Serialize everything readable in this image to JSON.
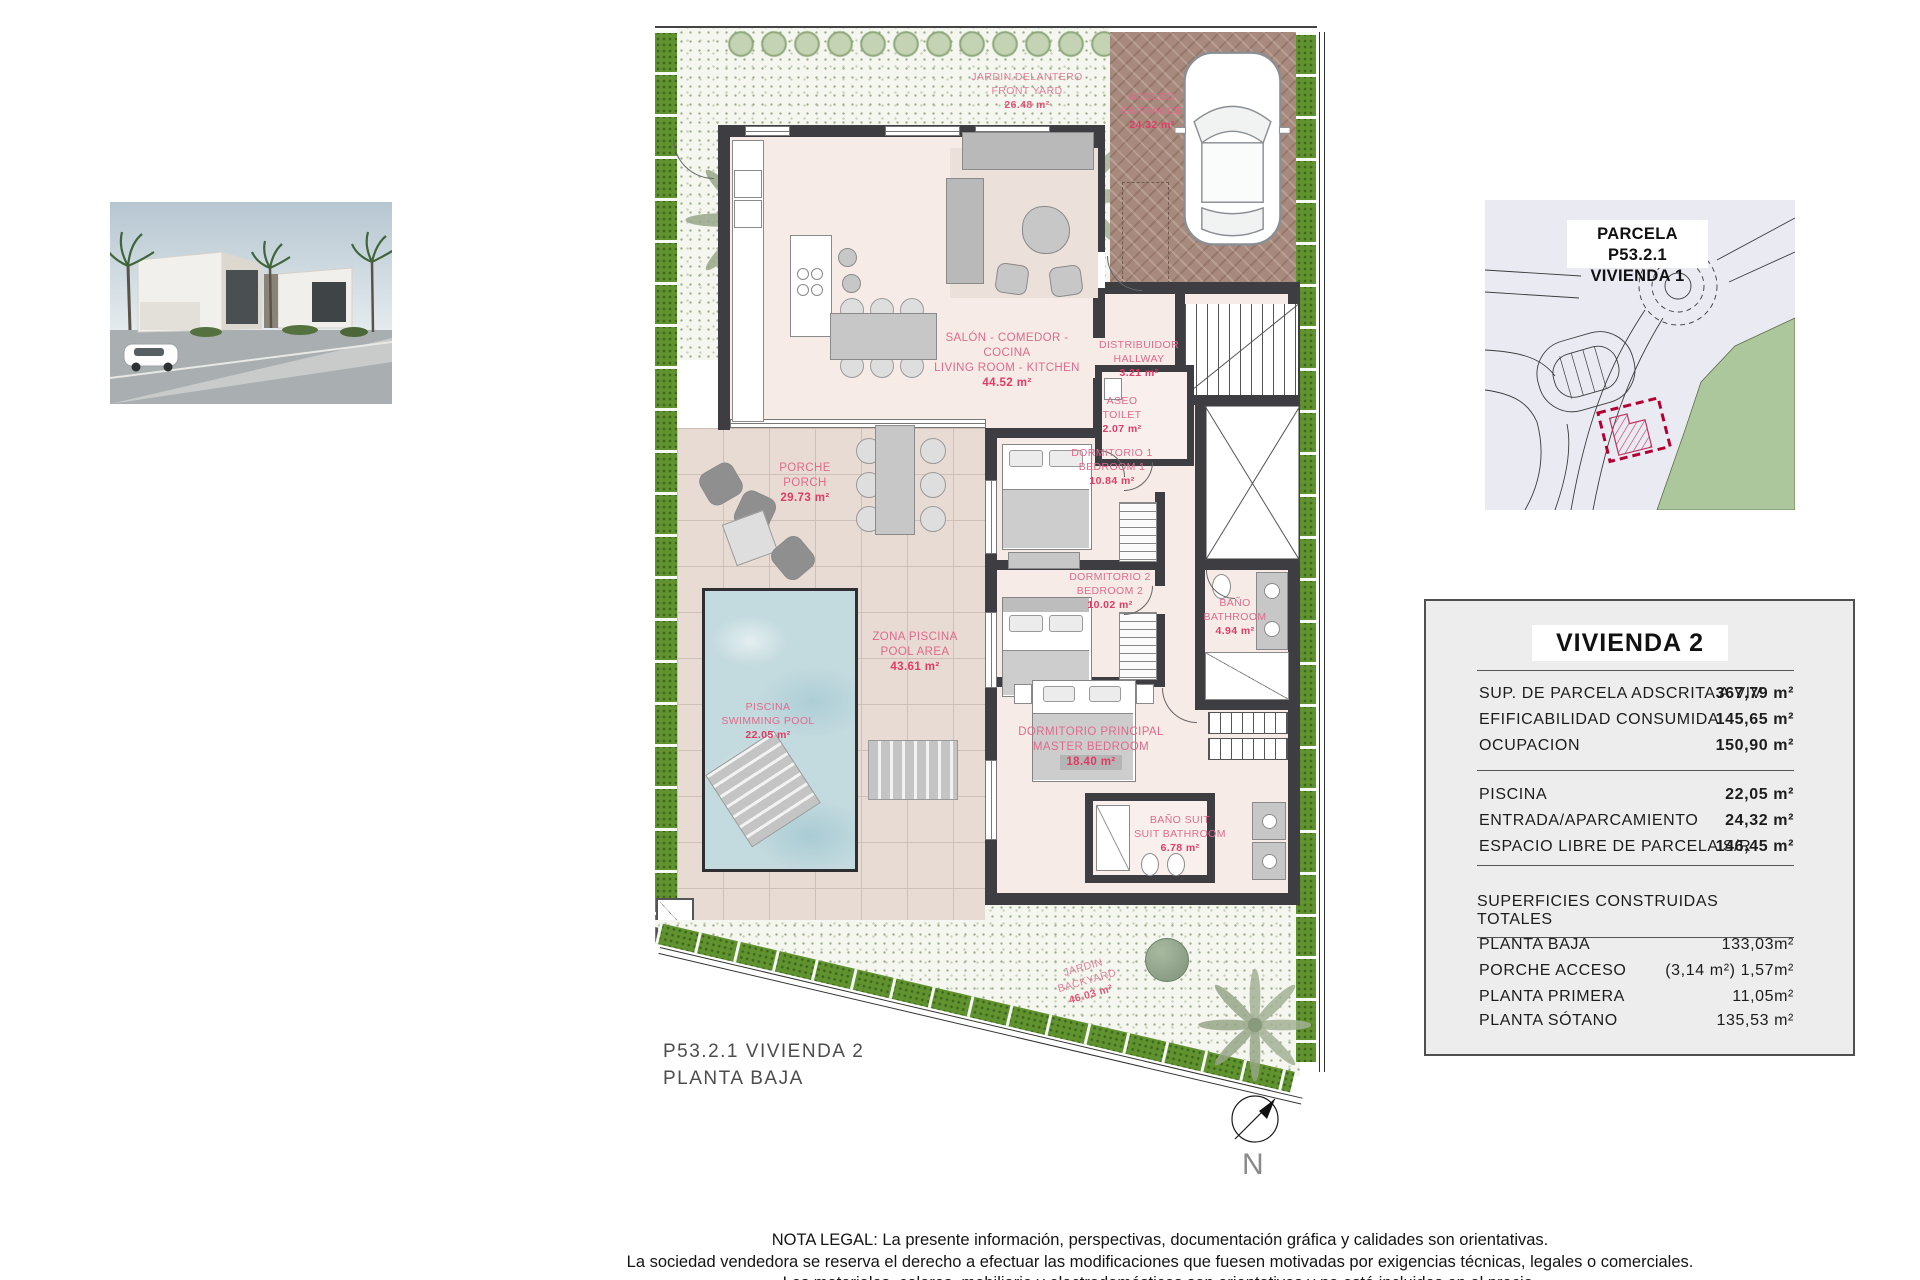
{
  "colors": {
    "label_pink": "#e06a8c",
    "area_red": "#e23a64",
    "wall_dark": "#3d3d42",
    "hedge_green": "#60922f",
    "pool_blue": "#c3dade",
    "driveway_brown": "#a78a7d",
    "terrace_tan": "#e8dbd3",
    "interior_pink": "#f6ebe7",
    "parcel_red": "#c2003a"
  },
  "plan_title": {
    "line1": "P53.2.1 VIVIENDA 2",
    "line2": "PLANTA BAJA"
  },
  "north_label": "N",
  "site_plan": {
    "title_line1": "PARCELA P53.2.1",
    "title_line2": "VIVIENDA 1"
  },
  "rooms": [
    {
      "es": "SALÓN - COMEDOR -COCINA",
      "en": "LIVING ROOM - KITCHEN",
      "area": "44.52 m²"
    },
    {
      "es": "PORCHE",
      "en": "PORCH",
      "area": "29.73 m²"
    },
    {
      "es": "ZONA PISCINA",
      "en": "POOL AREA",
      "area": "43.61 m²"
    },
    {
      "es": "PISCINA",
      "en": "SWIMMING POOL",
      "area": "22.05 m²"
    },
    {
      "es": "DORMITORIO 1",
      "en": "BEDROOM 1",
      "area": "10.84 m²"
    },
    {
      "es": "DORMITORIO 2",
      "en": "BEDROOM 2",
      "area": "10.02 m²"
    },
    {
      "es": "DORMITORIO PRINCIPAL",
      "en": "MASTER BEDROOM",
      "area": "18.40 m²"
    },
    {
      "es": "BAÑO",
      "en": "BATHROOM",
      "area": "4.94 m²"
    },
    {
      "es": "BAÑO SUIT",
      "en": "SUIT BATHROOM",
      "area": "6.78 m²"
    },
    {
      "es": "DISTRIBUIDOR",
      "en": "HALLWAY",
      "area": "3.21 m²"
    },
    {
      "es": "ASEO",
      "en": "TOILET",
      "area": "2.07 m²"
    },
    {
      "es": "ACCESO",
      "en": "ENTRANCE",
      "area": "24.32 m²"
    },
    {
      "es": "JARDIN DELANTERO",
      "en": "FRONT YARD",
      "area": "26.48 m²"
    },
    {
      "es": "JARDIN",
      "en": "BACKYARD",
      "area": "46.03 m²"
    }
  ],
  "info_panel": {
    "title": "VIVIENDA 2",
    "parcel_rows": [
      {
        "label": "SUP. DE PARCELA ADSCRITA A VIV.",
        "value": "367,79 m²"
      },
      {
        "label": "EFIFICABILIDAD CONSUMIDA",
        "value": "145,65 m²"
      },
      {
        "label": "OCUPACION",
        "value": "150,90 m²"
      }
    ],
    "exterior_rows": [
      {
        "label": "PISCINA",
        "value": "22,05 m²"
      },
      {
        "label": "ENTRADA/APARCAMIENTO",
        "value": "24,32 m²"
      },
      {
        "label": "ESPACIO LIBRE DE PARCELA S/R",
        "value": "146,45 m²"
      }
    ],
    "built_heading": "SUPERFICIES CONSTRUIDAS TOTALES",
    "built_rows": [
      {
        "label": "PLANTA BAJA",
        "value": "133,03m²"
      },
      {
        "label": "PORCHE ACCESO",
        "value": "(3,14 m²) 1,57m²"
      },
      {
        "label": "PLANTA PRIMERA",
        "value": "11,05m²"
      },
      {
        "label": "PLANTA SÓTANO",
        "value": "135,53 m²"
      }
    ]
  },
  "legal": {
    "line1": "NOTA LEGAL: La presente información, perspectivas, documentación gráfica y calidades son orientativas.",
    "line2": "La sociedad vendedora se reserva el derecho a efectuar las modificaciones que fuesen motivadas por exigencias técnicas, legales o comerciales.",
    "line3": "Los materiales, colores, mobiliario y electrodomésticos son orientativos y no está incluidos en el precio."
  }
}
